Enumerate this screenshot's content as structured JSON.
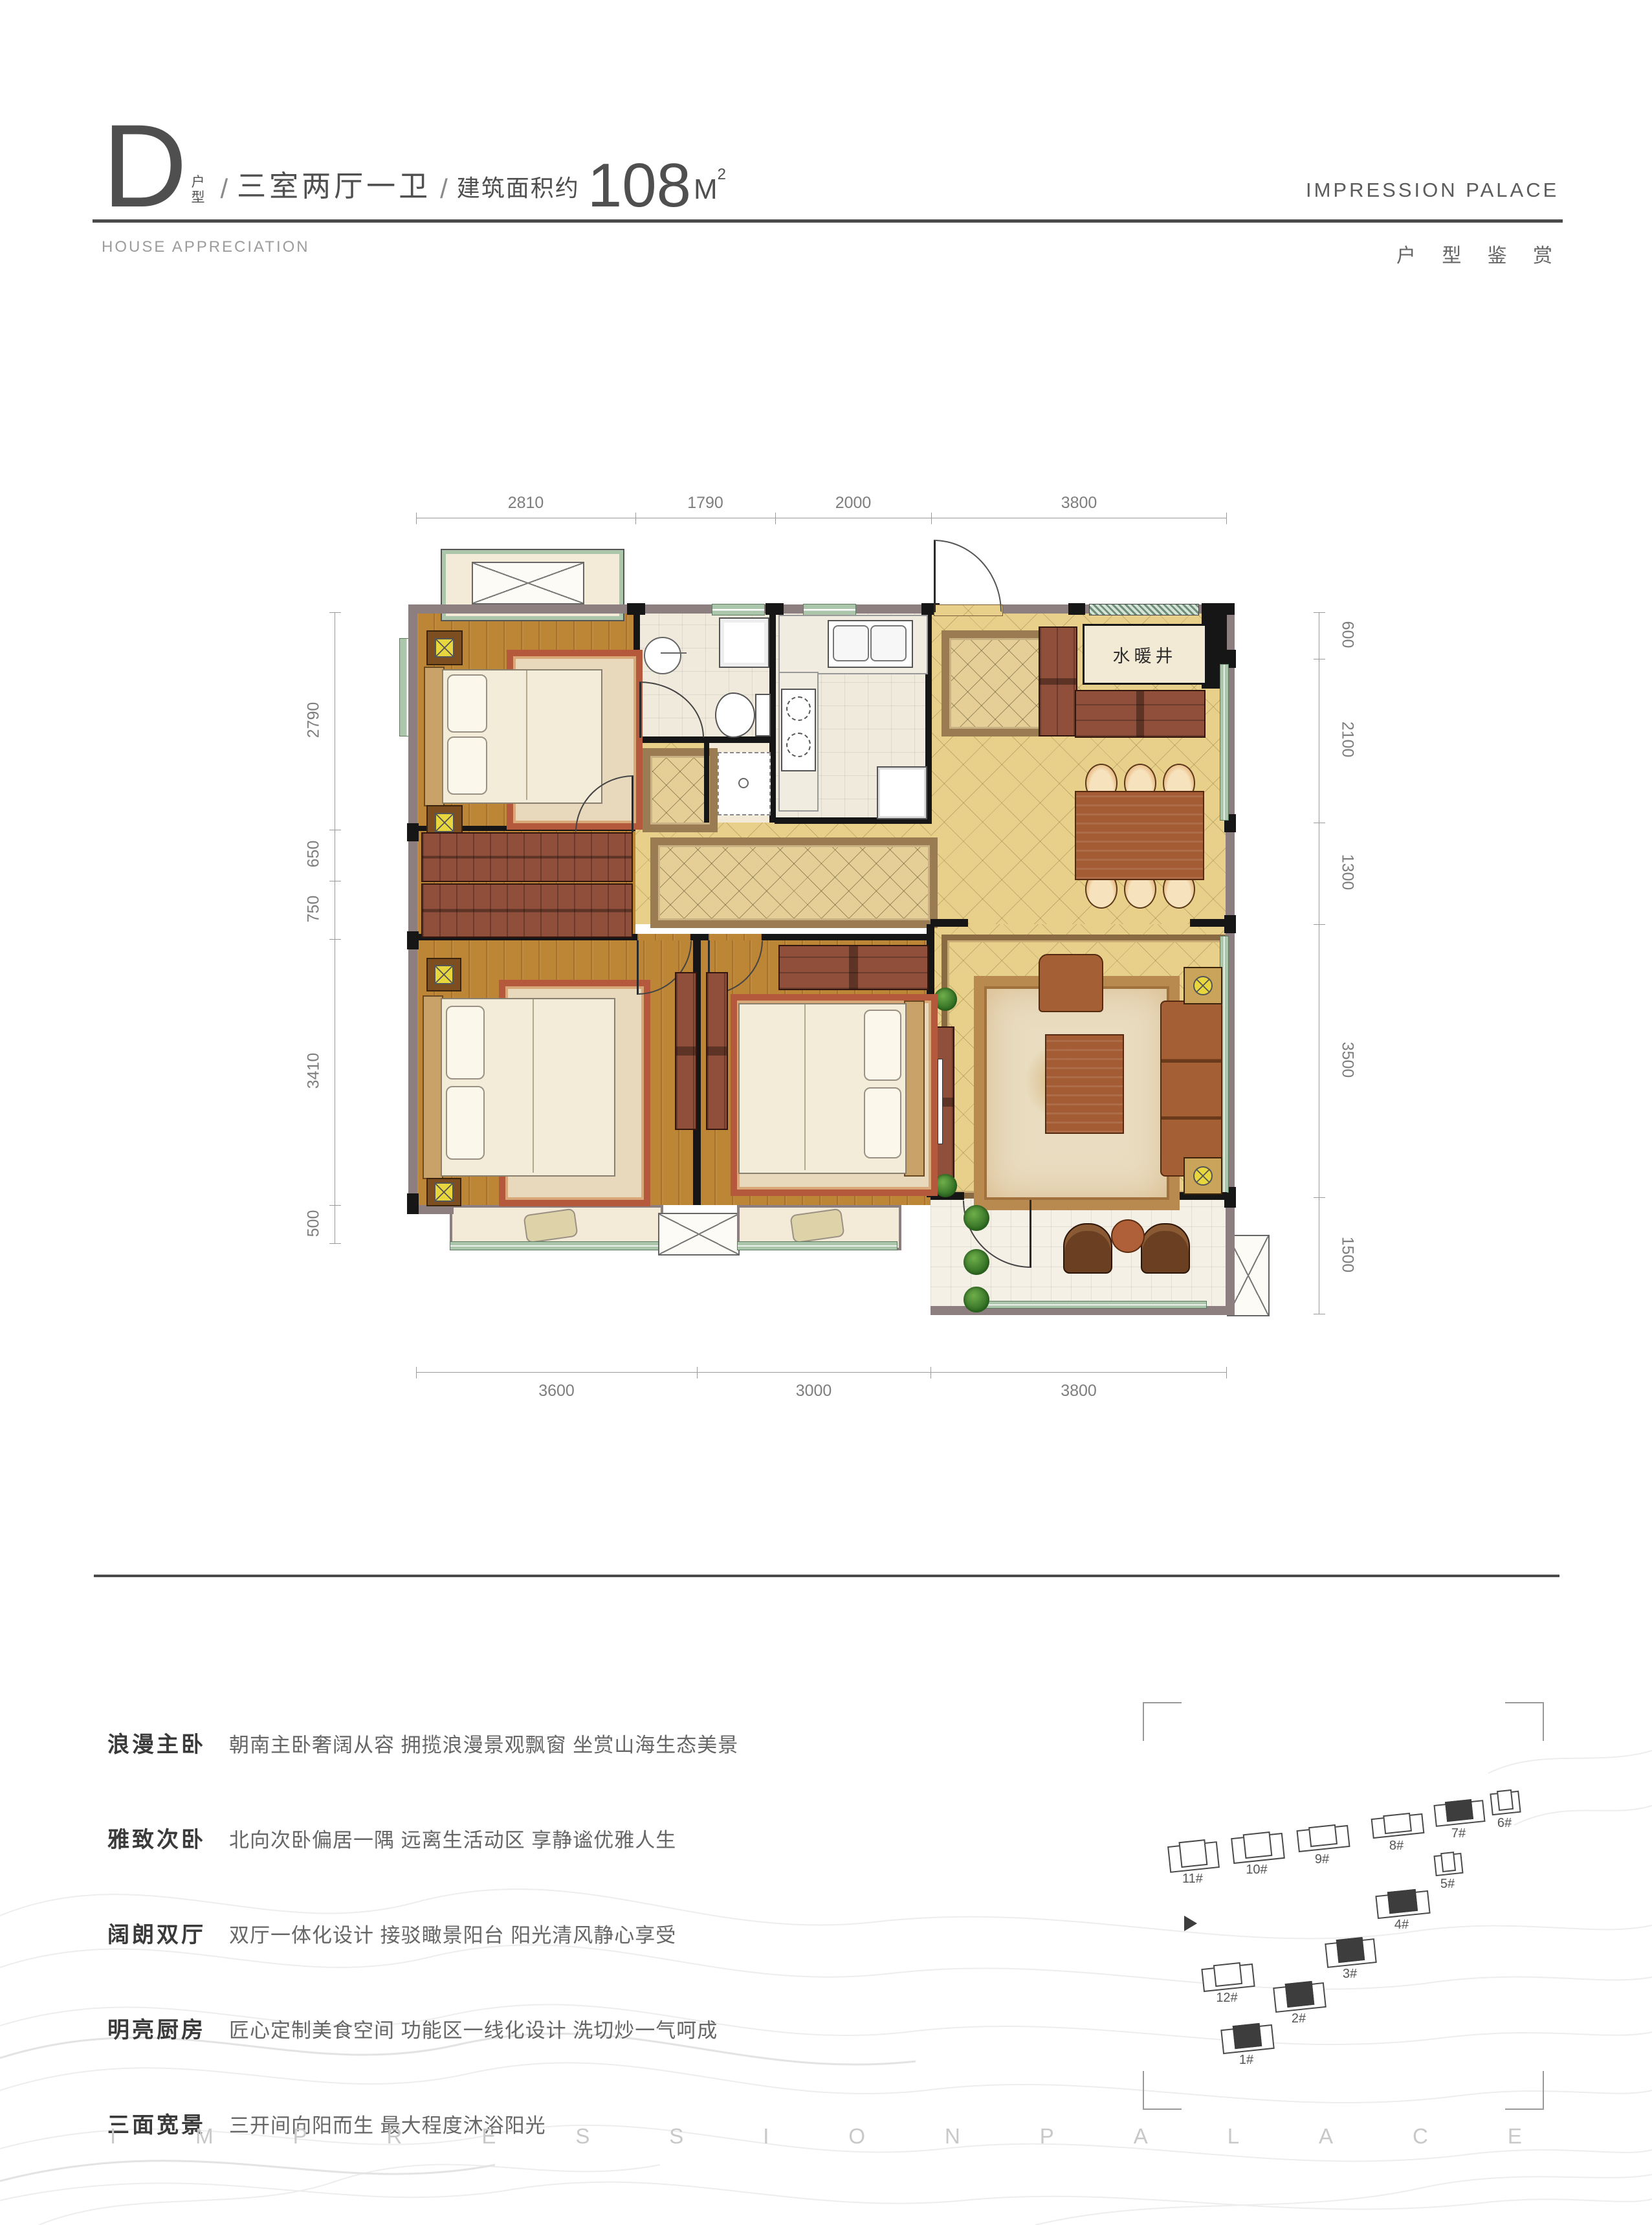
{
  "header": {
    "type_letter": "D",
    "type_suffix_top": "户",
    "type_suffix_bottom": "型",
    "slash": "/",
    "layout": "三室两厅一卫",
    "area_prefix": "建筑面积约",
    "area_value": "108",
    "area_unit": "M",
    "area_sup": "2",
    "brand": "IMPRESSION PALACE",
    "subtitle_en": "HOUSE APPRECIATION",
    "subtitle_cn": "户 型 鉴 赏"
  },
  "plan": {
    "room_label": "水暖井",
    "dims": {
      "top": [
        "2810",
        "1790",
        "2000",
        "3800"
      ],
      "bottom": [
        "3600",
        "3000",
        "3800"
      ],
      "left": [
        "2790",
        "650",
        "750",
        "3410",
        "500"
      ],
      "right": [
        "600",
        "2100",
        "1300",
        "3500",
        "1500"
      ]
    }
  },
  "features": [
    {
      "label": "浪漫主卧",
      "desc": "朝南主卧奢阔从容  拥揽浪漫景观飘窗  坐赏山海生态美景"
    },
    {
      "label": "雅致次卧",
      "desc": "北向次卧偏居一隅  远离生活动区  享静谧优雅人生"
    },
    {
      "label": "阔朗双厅",
      "desc": "双厅一体化设计  接驳瞰景阳台  阳光清风静心享受"
    },
    {
      "label": "明亮厨房",
      "desc": "匠心定制美食空间  功能区一线化设计  洗切炒一气呵成"
    },
    {
      "label": "三面宽景",
      "desc": "三开间向阳而生  最大程度沐浴阳光"
    }
  ],
  "site": {
    "buildings": [
      {
        "label": "1#"
      },
      {
        "label": "2#"
      },
      {
        "label": "3#"
      },
      {
        "label": "4#"
      },
      {
        "label": "5#"
      },
      {
        "label": "6#"
      },
      {
        "label": "7#"
      },
      {
        "label": "8#"
      },
      {
        "label": "9#"
      },
      {
        "label": "10#"
      },
      {
        "label": "11#"
      },
      {
        "label": "12#"
      }
    ]
  },
  "footer": {
    "letters": [
      "I",
      "M",
      "P",
      "R",
      "E",
      "S",
      "S",
      "I",
      "O",
      "N",
      "P",
      "A",
      "L",
      "A",
      "C",
      "E"
    ]
  },
  "colors": {
    "wood_floor": "#bd8536",
    "marble_floor": "#e9d08a",
    "window_green": "#abc6ab",
    "wall_gray": "#8d7e7f",
    "wall_dark": "#161616",
    "accent_red_wood": "#8f4f3b"
  }
}
